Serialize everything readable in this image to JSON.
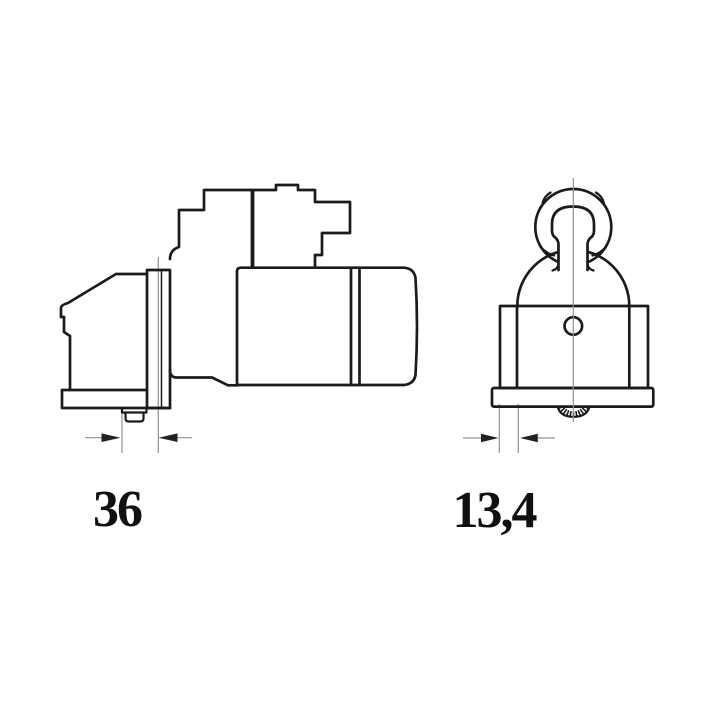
{
  "drawing": {
    "background": "#ffffff",
    "line_color": "#1b1b1b",
    "thin_line_color": "#909090",
    "label_color": "#101010",
    "views": [
      {
        "name": "side-view",
        "dimension_label": "36"
      },
      {
        "name": "front-view",
        "dimension_label": "13,4"
      }
    ]
  }
}
